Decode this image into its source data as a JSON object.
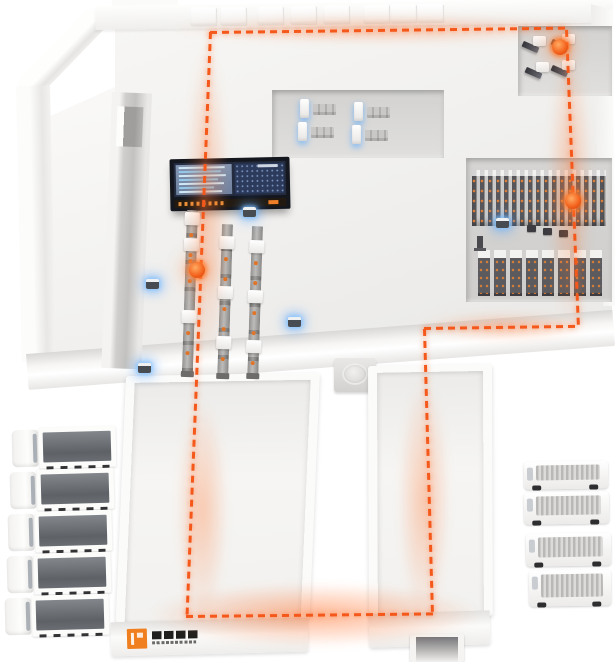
{
  "scene": {
    "width": 615,
    "height": 662,
    "background": "#ffffff",
    "description": "isometric smart warehouse with AGV route"
  },
  "colors": {
    "route_orange": "#f4581b",
    "marker_orange": "#f4651f",
    "glow_blue": "#58a8ff",
    "brand_orange": "#ef7f1f",
    "dashboard_frame": "#14171e",
    "floor_light": "#f2f1ef",
    "room_gray": "#d8d7d5"
  },
  "building": {
    "wall_pillars": [
      95,
      125,
      162,
      195,
      228,
      268,
      295,
      322
    ]
  },
  "dashboard": {
    "left_panel_lines": [
      92,
      84,
      95,
      78,
      90,
      70,
      86
    ]
  },
  "machines": {
    "mid_room": [
      {
        "x": 300,
        "y": 99
      },
      {
        "x": 298,
        "y": 122
      },
      {
        "x": 354,
        "y": 102
      },
      {
        "x": 352,
        "y": 125
      }
    ],
    "top_right_room": [
      {
        "x": 522,
        "y": 36
      },
      {
        "x": 525,
        "y": 62
      },
      {
        "x": 551,
        "y": 34
      },
      {
        "x": 551,
        "y": 60
      }
    ]
  },
  "racks": {
    "row_b_blocks": 8,
    "misc_boxes": [
      {
        "x": 527,
        "y": 225
      },
      {
        "x": 543,
        "y": 228
      },
      {
        "x": 559,
        "y": 230
      }
    ]
  },
  "conveyors": [
    {
      "x": 187,
      "y": 210,
      "h": 164,
      "r": 1.8,
      "boxes": [
        2,
        28,
        100
      ]
    },
    {
      "x": 222,
      "y": 224,
      "h": 152,
      "r": 1.8,
      "boxes": [
        12,
        62,
        112
      ]
    },
    {
      "x": 252,
      "y": 226,
      "h": 150,
      "r": 1.8,
      "boxes": [
        14,
        64,
        114
      ]
    }
  ],
  "agvs": [
    {
      "x": 146,
      "y": 279
    },
    {
      "x": 288,
      "y": 317
    },
    {
      "x": 138,
      "y": 363
    },
    {
      "x": 243,
      "y": 207
    },
    {
      "x": 496,
      "y": 218
    }
  ],
  "fleet": {
    "trucks": [
      {
        "x": 12,
        "y": 427
      },
      {
        "x": 10,
        "y": 469
      },
      {
        "x": 8,
        "y": 511
      },
      {
        "x": 7,
        "y": 553
      },
      {
        "x": 5,
        "y": 595
      }
    ],
    "vans": [
      {
        "x": 524,
        "y": 461,
        "w": 84,
        "h": 28
      },
      {
        "x": 524,
        "y": 492,
        "w": 85,
        "h": 32
      },
      {
        "x": 526,
        "y": 533,
        "w": 85,
        "h": 33
      },
      {
        "x": 529,
        "y": 570,
        "w": 82,
        "h": 36
      }
    ]
  },
  "path": {
    "dash_color": "#f4581b",
    "segments": [
      {
        "o": "h",
        "x": 210,
        "y": 31,
        "len": 357,
        "r": -0.7
      },
      {
        "o": "v",
        "x": 565,
        "y": 30,
        "len": 299,
        "r": -2.3
      },
      {
        "o": "h",
        "x": 424,
        "y": 327,
        "len": 154,
        "r": -0.8
      },
      {
        "o": "v",
        "x": 423,
        "y": 329,
        "len": 288,
        "r": -1.6
      },
      {
        "o": "h",
        "x": 186,
        "y": 615,
        "len": 247,
        "r": -0.6
      },
      {
        "o": "v",
        "x": 209,
        "y": 32,
        "len": 585,
        "r": 2.3
      }
    ],
    "markers": [
      {
        "x": 560,
        "y": 47
      },
      {
        "x": 573,
        "y": 201
      },
      {
        "x": 197,
        "y": 270
      }
    ],
    "glows": [
      {
        "x": 170,
        "y": 14,
        "w": 420,
        "h": 30
      },
      {
        "x": 548,
        "y": 40,
        "w": 44,
        "h": 290
      },
      {
        "x": 420,
        "y": 312,
        "w": 170,
        "h": 30
      },
      {
        "x": 185,
        "y": 40,
        "w": 44,
        "h": 330
      },
      {
        "x": 176,
        "y": 400,
        "w": 52,
        "h": 220
      },
      {
        "x": 398,
        "y": 380,
        "w": 52,
        "h": 240
      },
      {
        "x": 150,
        "y": 583,
        "w": 330,
        "h": 64,
        "strong": true
      }
    ]
  }
}
